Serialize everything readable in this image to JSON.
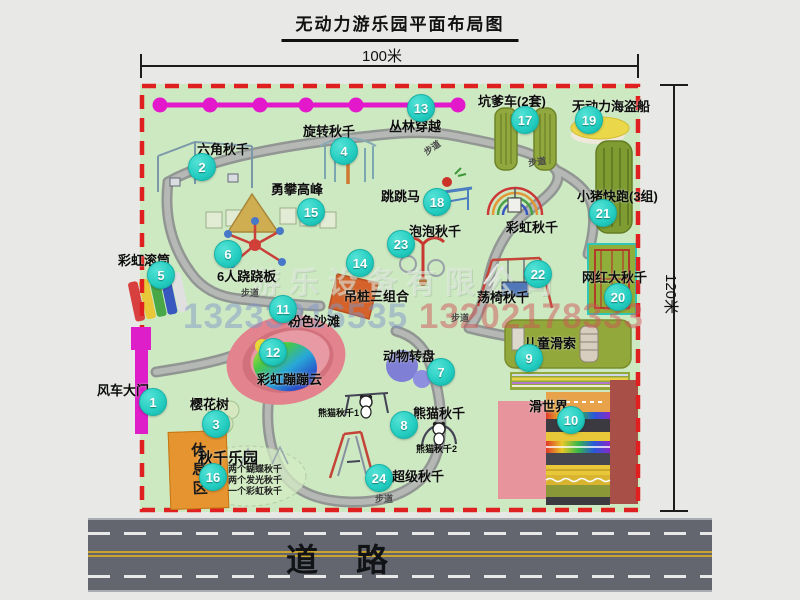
{
  "title": "无动力游乐园平面布局图",
  "dimensions": {
    "width_label": "100米",
    "height_label": "120米"
  },
  "road": {
    "label": "道路"
  },
  "rest_area_label": "休息区",
  "path_label": "步道",
  "watermark": {
    "company": "游乐设备有限公司",
    "phone1": "13233816535",
    "phone2": "13202178333"
  },
  "attractions": {
    "a1": {
      "num": "1",
      "label": "风车大门"
    },
    "a2": {
      "num": "2",
      "label": "六角秋千"
    },
    "a3": {
      "num": "3",
      "label": "樱花树"
    },
    "a4": {
      "num": "4",
      "label": "旋转秋千"
    },
    "a5": {
      "num": "5",
      "label": "彩虹滚筒"
    },
    "a6": {
      "num": "6",
      "label": "6人跷跷板"
    },
    "a7": {
      "num": "7",
      "label": "动物转盘"
    },
    "a8": {
      "num": "8",
      "label": "熊猫秋千"
    },
    "a9": {
      "num": "9",
      "label": "儿童滑索"
    },
    "a10": {
      "num": "10",
      "label": "滑世界"
    },
    "a11": {
      "num": "11",
      "label": "粉色沙滩"
    },
    "a12": {
      "num": "12",
      "label": "彩虹蹦蹦云"
    },
    "a13": {
      "num": "13",
      "label": "丛林穿越"
    },
    "a14": {
      "num": "14",
      "label": "吊桩三组合"
    },
    "a15": {
      "num": "15",
      "label": "勇攀高峰"
    },
    "a16": {
      "num": "16",
      "label": "秋千乐园",
      "sub1": "两个蝴蝶秋千",
      "sub2": "两个发光秋千",
      "sub3": "一个彩虹秋千"
    },
    "a17": {
      "num": "17",
      "label": "坑爹车(2套)"
    },
    "a18": {
      "num": "18",
      "label": "跳跳马"
    },
    "a19": {
      "num": "19",
      "label": "无动力海盗船"
    },
    "a20": {
      "num": "20",
      "label": "网红大秋千"
    },
    "a21": {
      "num": "21",
      "label": "小猪快跑(3组)"
    },
    "a22": {
      "num": "22",
      "label": "荡椅秋千"
    },
    "a23": {
      "num": "23",
      "label": "泡泡秋千"
    },
    "a24": {
      "num": "24",
      "label": "超级秋千"
    },
    "rainbow": {
      "label": "彩虹秋千"
    },
    "panda1": {
      "label": "熊猫秋千1"
    },
    "panda2": {
      "label": "熊猫秋千2"
    }
  }
}
